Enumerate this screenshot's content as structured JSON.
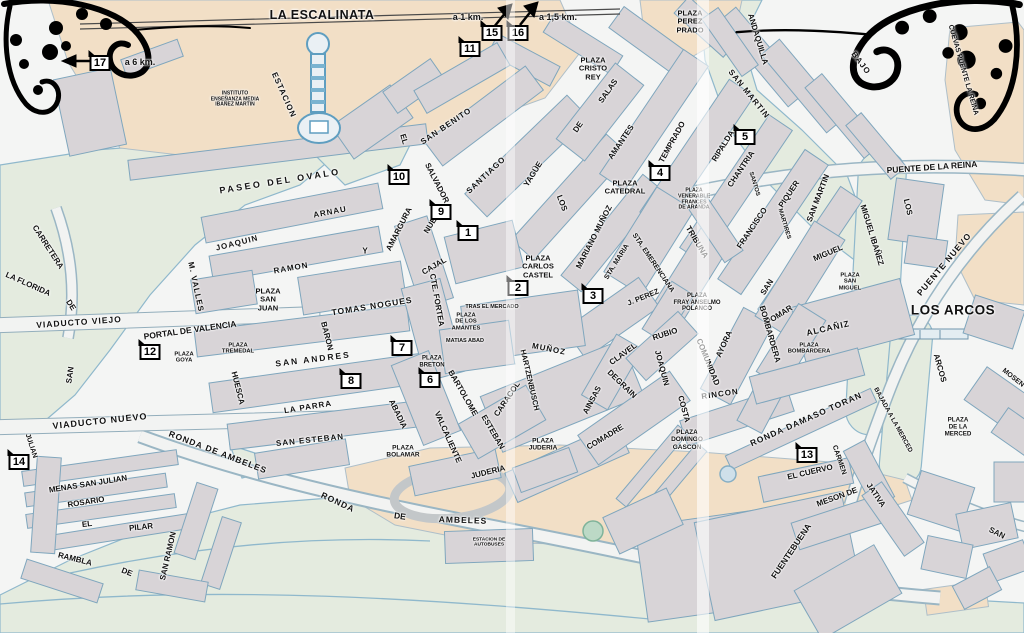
{
  "map": {
    "area_titles": {
      "la_escalinata": {
        "text": "LA ESCALINATA"
      },
      "los_arcos": {
        "text": "LOS ARCOS"
      }
    },
    "colors": {
      "bg": "#f4f5f4",
      "block": "#d8d4d7",
      "outline": "#7fa6bd",
      "tan": "#f2dfc6",
      "green": "#e4ebdf",
      "water": "#8fb8cc",
      "road": "#f2f3f2",
      "label": "#111111",
      "ornament": "#000000"
    },
    "distance_labels": [
      {
        "text": "a 6 km.",
        "x": 140,
        "y": 62
      },
      {
        "text": "a 1 km.",
        "x": 468,
        "y": 17
      },
      {
        "text": "a 1,5 km.",
        "x": 558,
        "y": 17
      }
    ],
    "markers": [
      {
        "n": "1",
        "x": 468,
        "y": 233
      },
      {
        "n": "2",
        "x": 518,
        "y": 288
      },
      {
        "n": "3",
        "x": 593,
        "y": 296
      },
      {
        "n": "4",
        "x": 660,
        "y": 173
      },
      {
        "n": "5",
        "x": 745,
        "y": 137
      },
      {
        "n": "6",
        "x": 430,
        "y": 380
      },
      {
        "n": "7",
        "x": 402,
        "y": 348
      },
      {
        "n": "8",
        "x": 351,
        "y": 381
      },
      {
        "n": "9",
        "x": 441,
        "y": 212
      },
      {
        "n": "10",
        "x": 399,
        "y": 177
      },
      {
        "n": "11",
        "x": 470,
        "y": 49
      },
      {
        "n": "12",
        "x": 150,
        "y": 352
      },
      {
        "n": "13",
        "x": 807,
        "y": 455
      },
      {
        "n": "14",
        "x": 19,
        "y": 462
      },
      {
        "n": "15",
        "x": 492,
        "y": 33
      },
      {
        "n": "16",
        "x": 518,
        "y": 33
      },
      {
        "n": "17",
        "x": 100,
        "y": 63
      }
    ],
    "street_labels": [
      {
        "t": "PASEO DEL OVALO",
        "x": 280,
        "y": 181,
        "r": -9,
        "s": 9,
        "ls": 2.5
      },
      {
        "t": "ESTACION",
        "x": 284,
        "y": 95,
        "r": 66,
        "s": 8,
        "ls": 1
      },
      {
        "t": "ARNAU",
        "x": 330,
        "y": 212,
        "r": -11,
        "s": 8,
        "ls": 1
      },
      {
        "t": "JOAQUIN",
        "x": 237,
        "y": 243,
        "r": -14,
        "s": 8,
        "ls": 1
      },
      {
        "t": "RAMON",
        "x": 291,
        "y": 268,
        "r": -10,
        "s": 8,
        "ls": 1
      },
      {
        "t": "Y",
        "x": 365,
        "y": 251,
        "r": 0,
        "s": 8
      },
      {
        "t": "M. VALLES",
        "x": 196,
        "y": 287,
        "r": 78,
        "s": 8,
        "ls": 1
      },
      {
        "t": "AMARGURA",
        "x": 399,
        "y": 229,
        "r": -63,
        "s": 8
      },
      {
        "t": "NUEVA",
        "x": 433,
        "y": 221,
        "r": -58,
        "s": 8
      },
      {
        "t": "CAJAL",
        "x": 434,
        "y": 266,
        "r": -30,
        "s": 8
      },
      {
        "t": "CTE. FORTEA",
        "x": 437,
        "y": 300,
        "r": 80,
        "s": 8
      },
      {
        "t": "TOMAS NOGUES",
        "x": 372,
        "y": 306,
        "r": -9,
        "s": 8.5,
        "ls": 1
      },
      {
        "t": "PORTAL DE VALENCIA",
        "x": 190,
        "y": 330,
        "r": -8,
        "s": 8.5
      },
      {
        "t": "SAN ANDRES",
        "x": 313,
        "y": 359,
        "r": -7,
        "s": 8.5,
        "ls": 2
      },
      {
        "t": "BARON",
        "x": 327,
        "y": 336,
        "r": 76,
        "s": 8
      },
      {
        "t": "HUESCA",
        "x": 238,
        "y": 388,
        "r": 76,
        "s": 8
      },
      {
        "t": "LA PARRA",
        "x": 308,
        "y": 407,
        "r": -9,
        "s": 8,
        "ls": 1
      },
      {
        "t": "SAN ESTEBAN",
        "x": 310,
        "y": 440,
        "r": -6,
        "s": 8,
        "ls": 1
      },
      {
        "t": "ABADIA",
        "x": 398,
        "y": 414,
        "r": 64,
        "s": 8
      },
      {
        "t": "VALCALIENTE",
        "x": 448,
        "y": 437,
        "r": 66,
        "s": 8
      },
      {
        "t": "BARTOLOME",
        "x": 463,
        "y": 393,
        "r": 60,
        "s": 8
      },
      {
        "t": "ESTEBAN",
        "x": 493,
        "y": 432,
        "r": 60,
        "s": 8
      },
      {
        "t": "CARACOL",
        "x": 507,
        "y": 399,
        "r": -56,
        "s": 8
      },
      {
        "t": "HARTZENBUSCH",
        "x": 530,
        "y": 380,
        "r": 77,
        "s": 7.5
      },
      {
        "t": "JUDERIA",
        "x": 488,
        "y": 472,
        "r": -14,
        "s": 8
      },
      {
        "t": "MUÑOZ",
        "x": 549,
        "y": 349,
        "r": 11,
        "s": 8,
        "ls": 1
      },
      {
        "t": "AINSAS",
        "x": 592,
        "y": 400,
        "r": -62,
        "s": 8
      },
      {
        "t": "DEGRAIN",
        "x": 622,
        "y": 384,
        "r": 44,
        "s": 8
      },
      {
        "t": "COMADRE",
        "x": 605,
        "y": 437,
        "r": -31,
        "s": 8
      },
      {
        "t": "CLAVEL",
        "x": 623,
        "y": 354,
        "r": -36,
        "s": 8
      },
      {
        "t": "RUBIO",
        "x": 665,
        "y": 334,
        "r": -18,
        "s": 8
      },
      {
        "t": "JOAQUIN",
        "x": 662,
        "y": 368,
        "r": 75,
        "s": 8
      },
      {
        "t": "COSTA",
        "x": 684,
        "y": 409,
        "r": 75,
        "s": 8
      },
      {
        "t": "RINCON",
        "x": 720,
        "y": 394,
        "r": -8,
        "s": 8,
        "ls": 1
      },
      {
        "t": "COMUNIDAD",
        "x": 708,
        "y": 362,
        "r": 68,
        "s": 8
      },
      {
        "t": "AYORA",
        "x": 724,
        "y": 344,
        "r": -65,
        "s": 8
      },
      {
        "t": "SALVADOR",
        "x": 437,
        "y": 183,
        "r": 63,
        "s": 8
      },
      {
        "t": "SAN BENITO",
        "x": 446,
        "y": 126,
        "r": -34,
        "s": 8,
        "ls": 1
      },
      {
        "t": "EL",
        "x": 404,
        "y": 139,
        "r": 73,
        "s": 8
      },
      {
        "t": "SANTIAGO",
        "x": 486,
        "y": 175,
        "r": -43,
        "s": 8,
        "ls": 1
      },
      {
        "t": "YAGÜE",
        "x": 533,
        "y": 174,
        "r": -58,
        "s": 8
      },
      {
        "t": "DE",
        "x": 578,
        "y": 127,
        "r": -55,
        "s": 8
      },
      {
        "t": "SALAS",
        "x": 608,
        "y": 91,
        "r": -55,
        "s": 8
      },
      {
        "t": "LOS",
        "x": 562,
        "y": 203,
        "r": 69,
        "s": 8
      },
      {
        "t": "AMANTES",
        "x": 621,
        "y": 142,
        "r": -56,
        "s": 8
      },
      {
        "t": "MARIANO MUÑOZ",
        "x": 594,
        "y": 237,
        "r": -63,
        "s": 8
      },
      {
        "t": "STA. MARIA",
        "x": 617,
        "y": 262,
        "r": -58,
        "s": 7
      },
      {
        "t": "STA. EMERENCIANA",
        "x": 653,
        "y": 263,
        "r": 56,
        "s": 7
      },
      {
        "t": "J. PEREZ",
        "x": 643,
        "y": 297,
        "r": -22,
        "s": 7.5
      },
      {
        "t": "TRIBUNA",
        "x": 697,
        "y": 242,
        "r": 59,
        "s": 8
      },
      {
        "t": "TEMPRADO",
        "x": 672,
        "y": 142,
        "r": -61,
        "s": 8
      },
      {
        "t": "RIPALDA",
        "x": 723,
        "y": 146,
        "r": -58,
        "s": 8
      },
      {
        "t": "CHANTRIA",
        "x": 741,
        "y": 169,
        "r": -56,
        "s": 8
      },
      {
        "t": "SANTOS",
        "x": 754,
        "y": 184,
        "r": 73,
        "s": 6
      },
      {
        "t": "FRANCISCO",
        "x": 752,
        "y": 228,
        "r": -56,
        "s": 8
      },
      {
        "t": "PIQUER",
        "x": 789,
        "y": 194,
        "r": -56,
        "s": 8
      },
      {
        "t": "MARTIRES",
        "x": 784,
        "y": 224,
        "r": 73,
        "s": 6
      },
      {
        "t": "SAN MARTIN",
        "x": 749,
        "y": 94,
        "r": 51,
        "s": 8,
        "ls": 1
      },
      {
        "t": "ANDAQUILLA",
        "x": 758,
        "y": 39,
        "r": 73,
        "s": 8
      },
      {
        "t": "BAJO",
        "x": 861,
        "y": 63,
        "r": 53,
        "s": 8,
        "ls": 1
      },
      {
        "t": "CUEVAS PUENTE LA REINA",
        "x": 963,
        "y": 70,
        "r": 74,
        "s": 7
      },
      {
        "t": "PUENTE DE LA REINA",
        "x": 932,
        "y": 167,
        "r": -4,
        "s": 8.5
      },
      {
        "t": "SAN MARTIN",
        "x": 818,
        "y": 198,
        "r": -69,
        "s": 8
      },
      {
        "t": "MIGUEL IBAÑEZ",
        "x": 872,
        "y": 235,
        "r": 73,
        "s": 8
      },
      {
        "t": "LOS",
        "x": 908,
        "y": 207,
        "r": 77,
        "s": 8
      },
      {
        "t": "PUENTE NUEVO",
        "x": 944,
        "y": 264,
        "r": -50,
        "s": 8.5,
        "ls": 1
      },
      {
        "t": "MIGUEL",
        "x": 828,
        "y": 253,
        "r": -23,
        "s": 8
      },
      {
        "t": "SAN",
        "x": 767,
        "y": 287,
        "r": -57,
        "s": 8
      },
      {
        "t": "POMAR",
        "x": 779,
        "y": 315,
        "r": -32,
        "s": 8
      },
      {
        "t": "BOMBARDERA",
        "x": 770,
        "y": 334,
        "r": 74,
        "s": 8
      },
      {
        "t": "ALCAÑIZ",
        "x": 828,
        "y": 328,
        "r": -13,
        "s": 8.5,
        "ls": 1
      },
      {
        "t": "ARCOS",
        "x": 940,
        "y": 368,
        "r": 74,
        "s": 8
      },
      {
        "t": "MOSEN",
        "x": 1013,
        "y": 378,
        "r": 38,
        "s": 7
      },
      {
        "t": "BAJADA A LA MERCED",
        "x": 893,
        "y": 420,
        "r": 61,
        "s": 6.5
      },
      {
        "t": "RONDA DAMASO TORAN",
        "x": 806,
        "y": 419,
        "r": -24,
        "s": 8.5,
        "ls": 1
      },
      {
        "t": "EL CUERVO",
        "x": 810,
        "y": 472,
        "r": -13,
        "s": 8
      },
      {
        "t": "CARMEN",
        "x": 839,
        "y": 460,
        "r": 71,
        "s": 7
      },
      {
        "t": "MESON DE",
        "x": 837,
        "y": 497,
        "r": -20,
        "s": 8
      },
      {
        "t": "JATIVA",
        "x": 876,
        "y": 495,
        "r": 56,
        "s": 8
      },
      {
        "t": "SAN",
        "x": 997,
        "y": 533,
        "r": 26,
        "s": 8
      },
      {
        "t": "FUENTEBUENA",
        "x": 791,
        "y": 551,
        "r": -56,
        "s": 8.5
      },
      {
        "t": "RONDA DE AMBELES",
        "x": 218,
        "y": 452,
        "r": 21,
        "s": 8.5,
        "ls": 1
      },
      {
        "t": "RONDA",
        "x": 338,
        "y": 502,
        "r": 25,
        "s": 8.5,
        "ls": 1
      },
      {
        "t": "DE",
        "x": 400,
        "y": 516,
        "r": 8,
        "s": 8.5
      },
      {
        "t": "AMBELES",
        "x": 463,
        "y": 520,
        "r": 2,
        "s": 8.5,
        "ls": 1
      },
      {
        "t": "VIADUCTO NUEVO",
        "x": 100,
        "y": 421,
        "r": -6,
        "s": 9,
        "ls": 1
      },
      {
        "t": "VIADUCTO VIEJO",
        "x": 79,
        "y": 322,
        "r": -4,
        "s": 8.5,
        "ls": 1
      },
      {
        "t": "LA FLORIDA",
        "x": 28,
        "y": 284,
        "r": 24,
        "s": 8
      },
      {
        "t": "CARRETERA",
        "x": 48,
        "y": 247,
        "r": 57,
        "s": 8
      },
      {
        "t": "DE",
        "x": 71,
        "y": 305,
        "r": 57,
        "s": 8
      },
      {
        "t": "SAN",
        "x": 70,
        "y": 375,
        "r": -82,
        "s": 8
      },
      {
        "t": "JULIAN",
        "x": 31,
        "y": 446,
        "r": 72,
        "s": 7
      },
      {
        "t": "MENAS SAN JULIAN",
        "x": 88,
        "y": 484,
        "r": -9,
        "s": 8
      },
      {
        "t": "ROSARIO",
        "x": 86,
        "y": 502,
        "r": -9,
        "s": 8
      },
      {
        "t": "EL",
        "x": 87,
        "y": 524,
        "r": -7,
        "s": 8
      },
      {
        "t": "PILAR",
        "x": 141,
        "y": 527,
        "r": -6,
        "s": 8
      },
      {
        "t": "RAMBLA",
        "x": 75,
        "y": 559,
        "r": 14,
        "s": 8
      },
      {
        "t": "DE",
        "x": 127,
        "y": 572,
        "r": 22,
        "s": 8
      },
      {
        "t": "SAN RAMON",
        "x": 168,
        "y": 556,
        "r": -77,
        "s": 8
      }
    ],
    "plaza_labels": [
      {
        "lines": [
          "PLAZA",
          "PEREZ",
          "PRADO"
        ],
        "x": 690,
        "y": 22,
        "s": 7.5
      },
      {
        "lines": [
          "PLAZA",
          "CRISTO",
          "REY"
        ],
        "x": 593,
        "y": 69,
        "s": 7.5
      },
      {
        "lines": [
          "PLAZA",
          "CATEDRAL"
        ],
        "x": 625,
        "y": 188,
        "s": 7.5
      },
      {
        "lines": [
          "PLAZA",
          "VENERABLE",
          "FRANCES",
          "DE ARANDA"
        ],
        "x": 694,
        "y": 200,
        "s": 5.2
      },
      {
        "lines": [
          "PLAZA",
          "CARLOS",
          "CASTEL"
        ],
        "x": 538,
        "y": 267,
        "s": 7.5
      },
      {
        "lines": [
          "PLAZA",
          "SAN",
          "JUAN"
        ],
        "x": 268,
        "y": 300,
        "s": 7.5
      },
      {
        "lines": [
          "PLAZA",
          "GOYA"
        ],
        "x": 184,
        "y": 358,
        "s": 5.8
      },
      {
        "lines": [
          "PLAZA",
          "TREMEDAL"
        ],
        "x": 238,
        "y": 349,
        "s": 5.8
      },
      {
        "lines": [
          "TRAS EL MERCADO"
        ],
        "x": 492,
        "y": 307,
        "s": 5.5
      },
      {
        "lines": [
          "PLAZA",
          "DE LOS",
          "AMANTES"
        ],
        "x": 466,
        "y": 322,
        "s": 5.8
      },
      {
        "lines": [
          "MATIAS  ABAD"
        ],
        "x": 465,
        "y": 341,
        "s": 5.5
      },
      {
        "lines": [
          "PLAZA",
          "FRAY ANSELMO",
          "POLANCO"
        ],
        "x": 697,
        "y": 303,
        "s": 6
      },
      {
        "lines": [
          "PLAZA",
          "BRETON"
        ],
        "x": 432,
        "y": 362,
        "s": 6
      },
      {
        "lines": [
          "PLAZA",
          "BOLAMAR"
        ],
        "x": 403,
        "y": 452,
        "s": 6.5
      },
      {
        "lines": [
          "PLAZA",
          "JUDERIA"
        ],
        "x": 543,
        "y": 445,
        "s": 6.5
      },
      {
        "lines": [
          "PLAZA",
          "DOMINGO",
          "GASCON"
        ],
        "x": 687,
        "y": 440,
        "s": 6.5
      },
      {
        "lines": [
          "PLAZA",
          "SAN",
          "MIGUEL"
        ],
        "x": 850,
        "y": 282,
        "s": 5.8
      },
      {
        "lines": [
          "PLAZA",
          "BOMBARDERA"
        ],
        "x": 809,
        "y": 349,
        "s": 5.8
      },
      {
        "lines": [
          "PLAZA",
          "DE LA",
          "MERCED"
        ],
        "x": 958,
        "y": 428,
        "s": 6.2
      },
      {
        "lines": [
          "INSTITUTO",
          "ENSEÑANZA MEDIA",
          "IBAÑEZ MARTIN"
        ],
        "x": 235,
        "y": 100,
        "s": 5
      },
      {
        "lines": [
          "ESTACION DE",
          "AUTOBUSES"
        ],
        "x": 489,
        "y": 543,
        "s": 4.8
      }
    ]
  }
}
